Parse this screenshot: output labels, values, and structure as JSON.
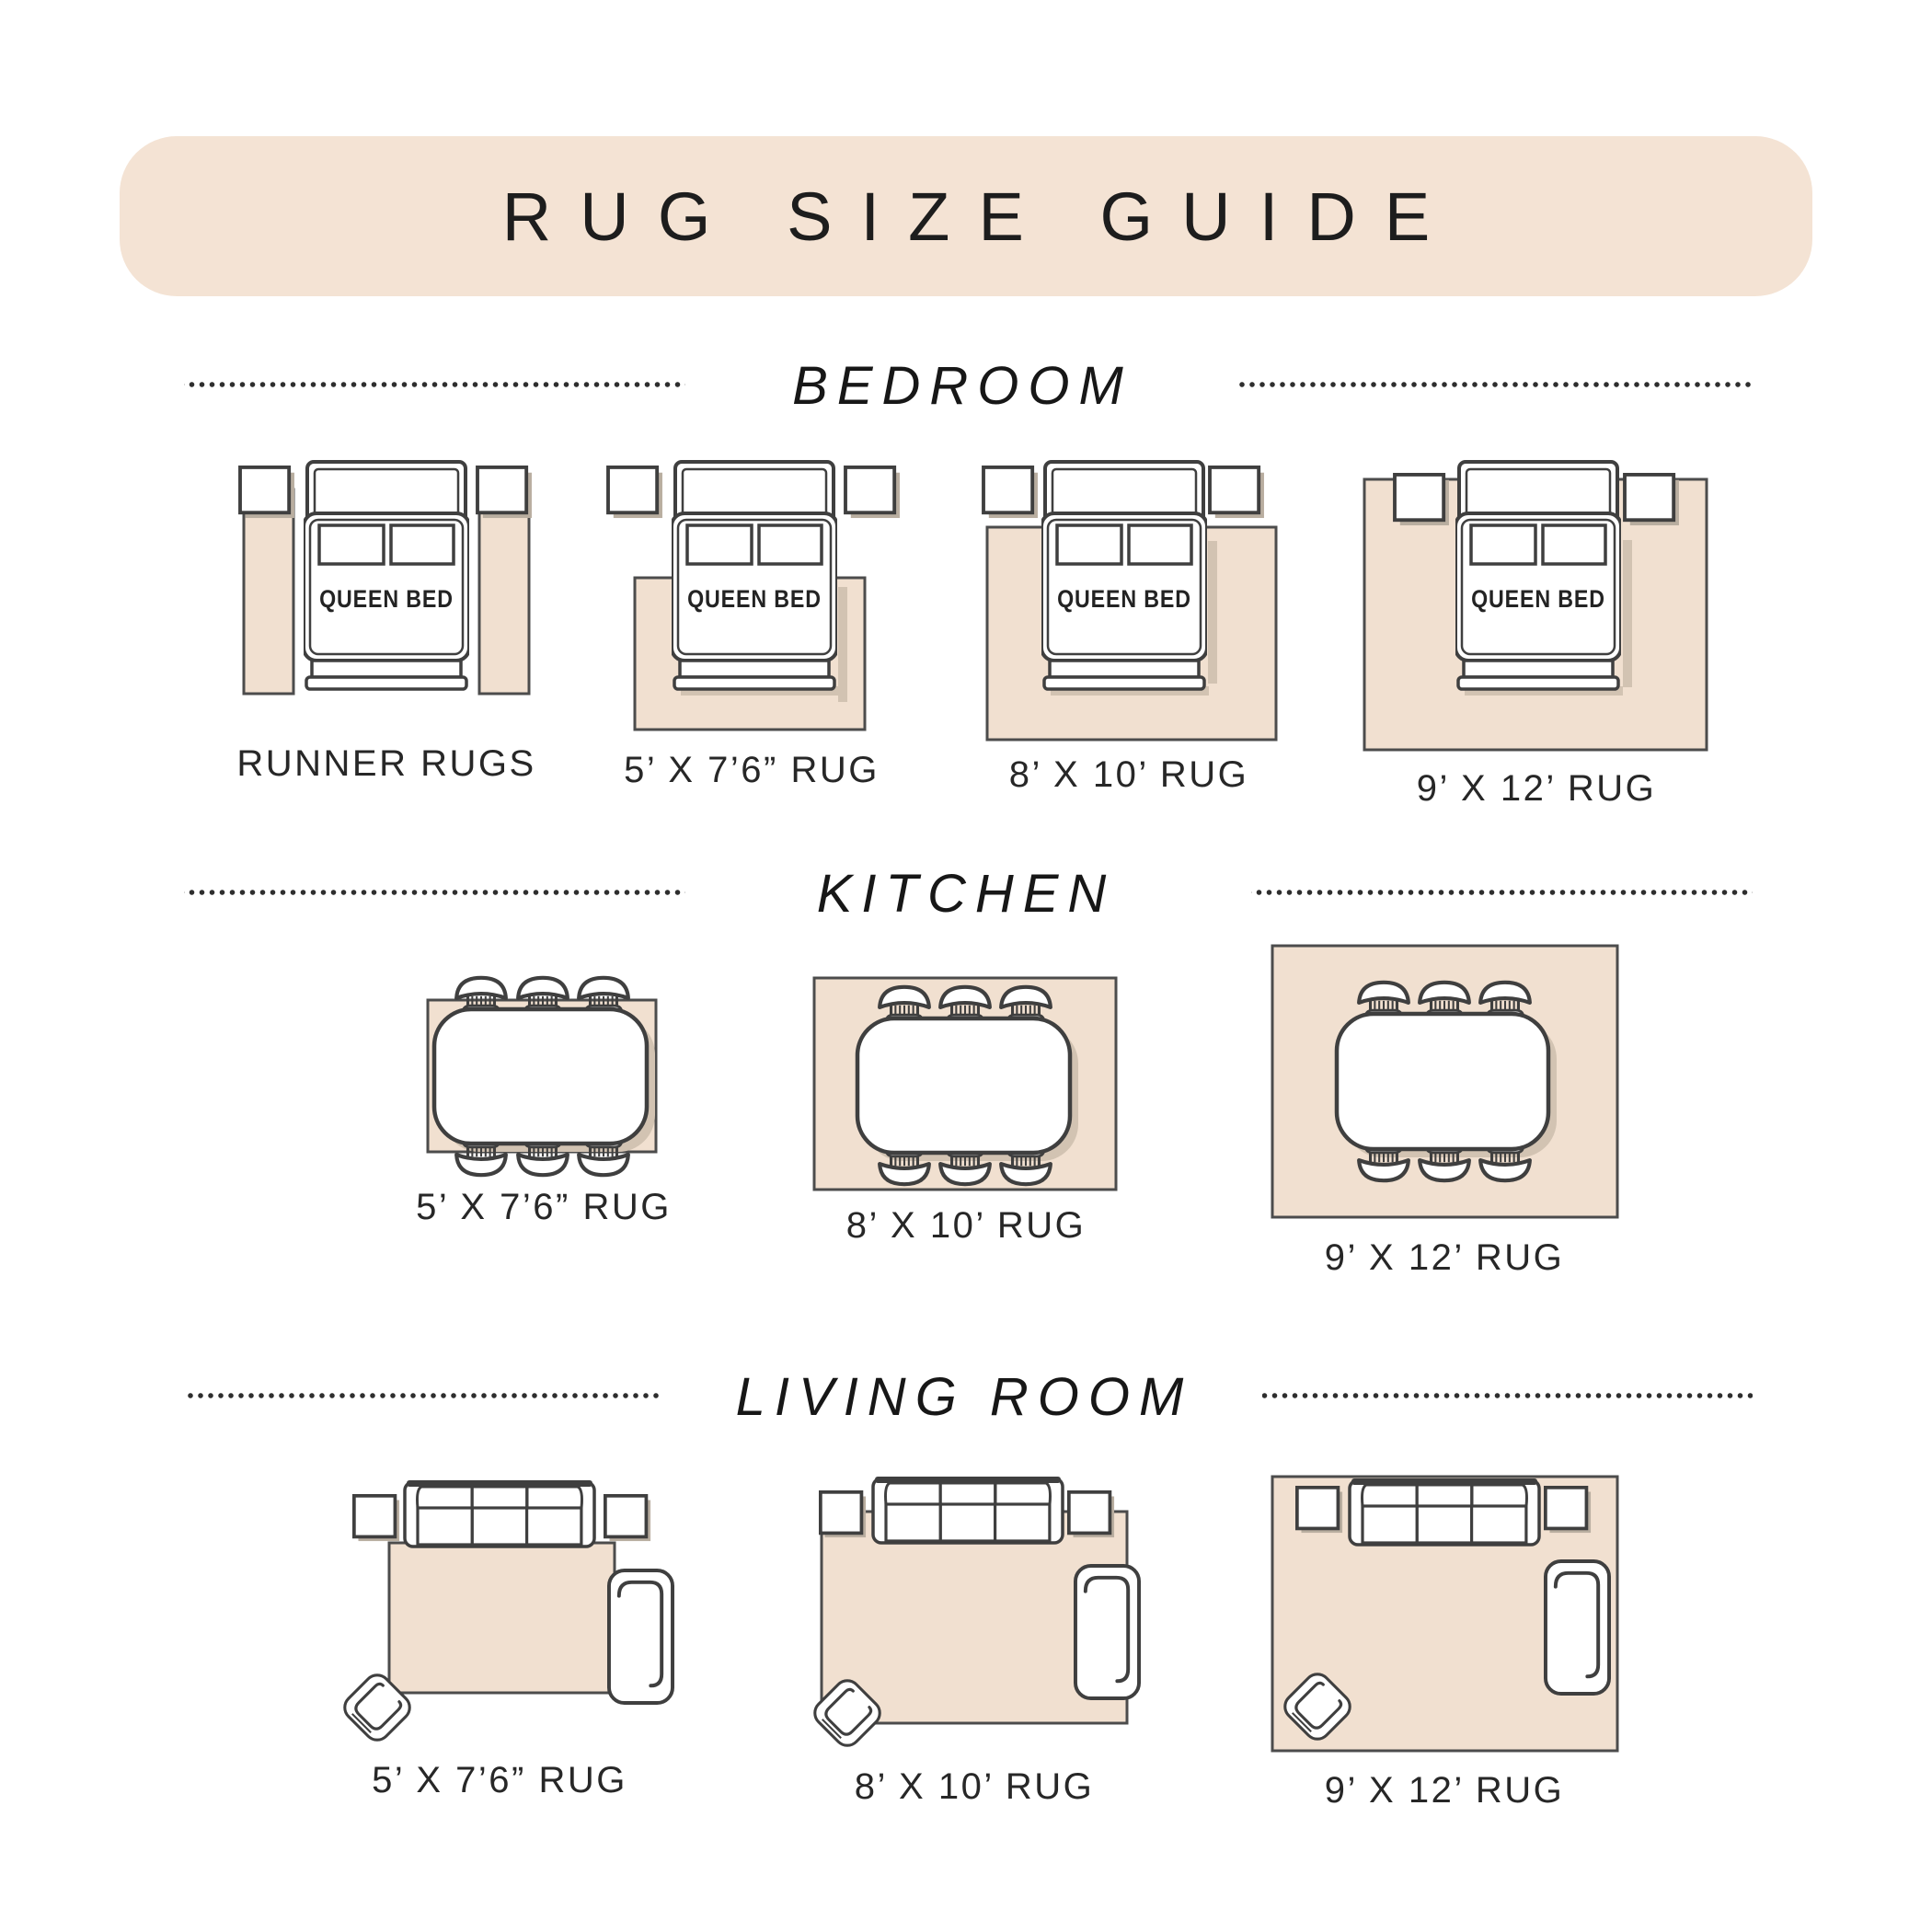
{
  "title": "RUG SIZE GUIDE",
  "queen_bed_label": "QUEEN BED",
  "sections": [
    {
      "name": "BEDROOM",
      "items": [
        {
          "label": "RUNNER RUGS"
        },
        {
          "label": "5’ X 7’6” RUG"
        },
        {
          "label": "8’ X 10’ RUG"
        },
        {
          "label": "9’ X 12’ RUG"
        }
      ]
    },
    {
      "name": "KITCHEN",
      "items": [
        {
          "label": "5’ X 7’6” RUG"
        },
        {
          "label": "8’ X 10’ RUG"
        },
        {
          "label": "9’ X 12’ RUG"
        }
      ]
    },
    {
      "name": "LIVING ROOM",
      "items": [
        {
          "label": "5’ X 7’6” RUG"
        },
        {
          "label": "8’ X 10’ RUG"
        },
        {
          "label": "9’ X 12’ RUG"
        }
      ]
    }
  ],
  "colors": {
    "band": "#f4e3d4",
    "rug": "#f1e0d0",
    "furniture_stroke": "#3f3f3f",
    "shadow": "#d2c3b2",
    "text": "#1e1e1e"
  }
}
